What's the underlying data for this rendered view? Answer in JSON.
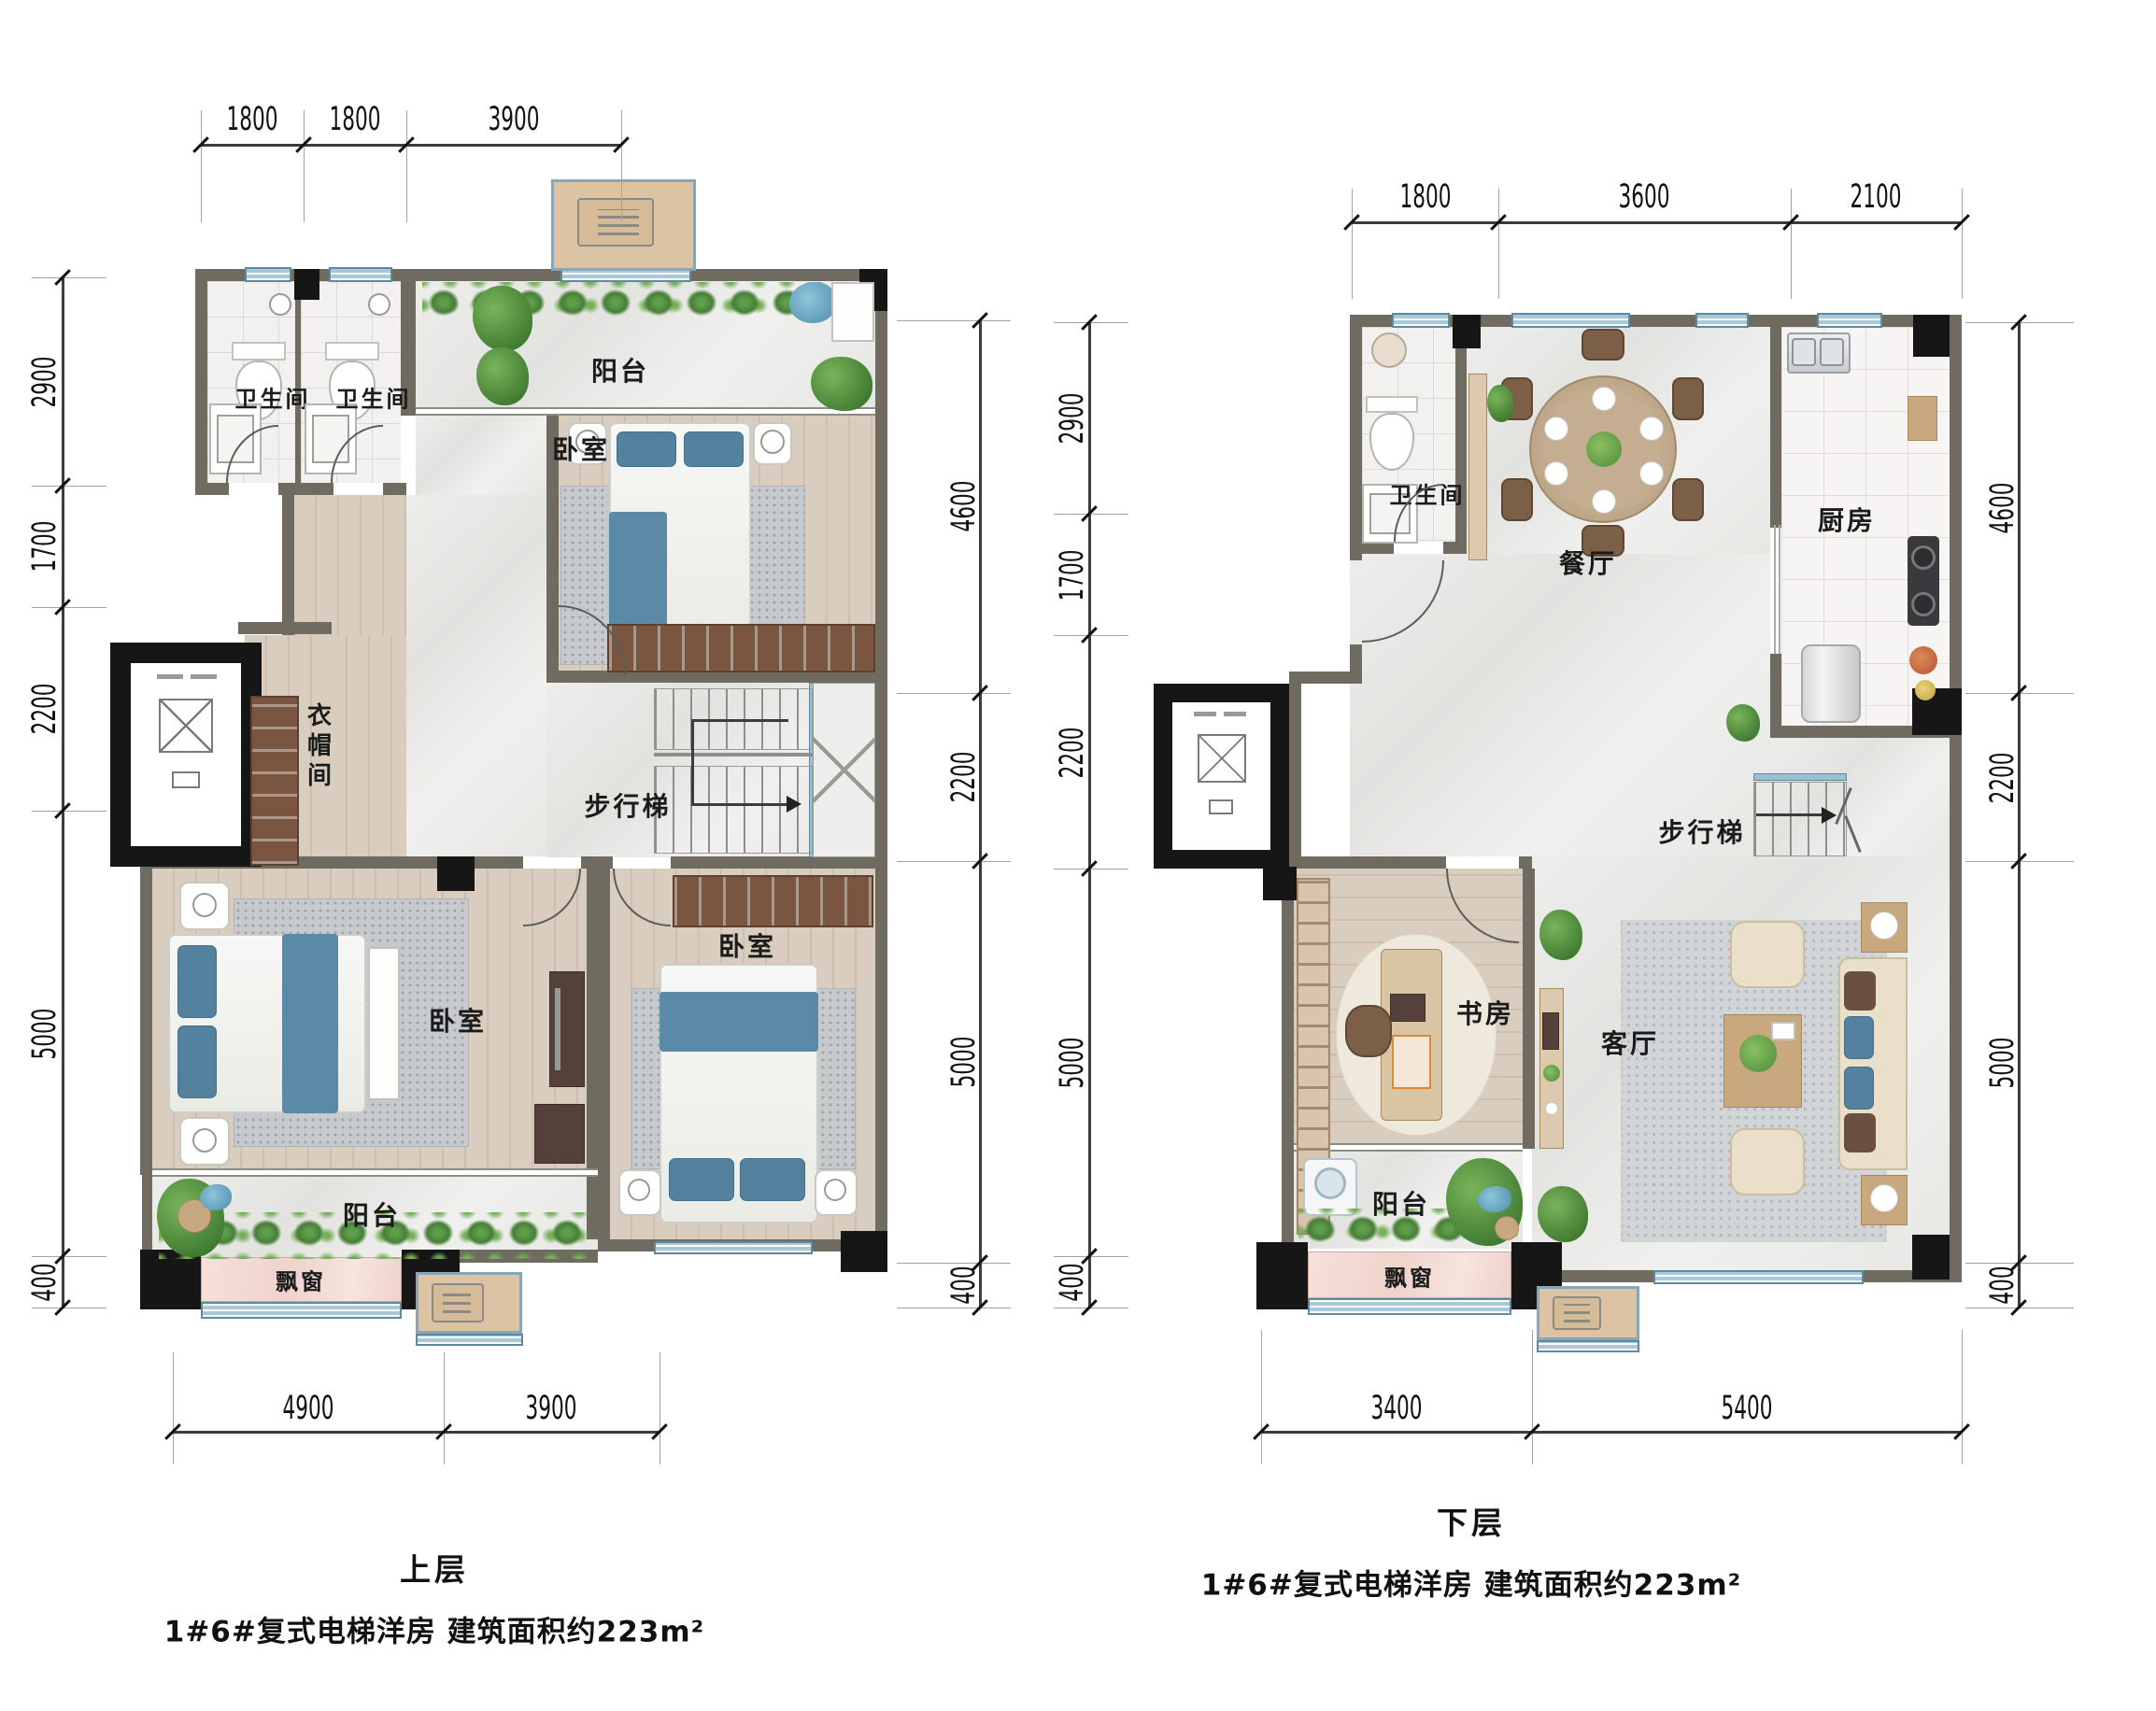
{
  "upper_label_note": "duplex floor plan, two plans side by side",
  "colors": {
    "wall": "#6f6b61",
    "column": "#161616",
    "window_blue": "#a9c9d9",
    "bay_pink": "#f6e0da",
    "wood_floor": "#d8cdbf",
    "marble_floor": "#ededeb",
    "plant_green": "#5e9e4b",
    "bed_blue": "#54819d",
    "ac_tan": "#dcc3a3"
  },
  "left_plan": {
    "title": "上层",
    "subtitle": "1#6#复式电梯洋房 建筑面积约223m²",
    "rooms": {
      "bath1": "卫生间",
      "bath2": "卫生间",
      "balcony_top": "阳台",
      "bedroom_top": "卧室",
      "closet": "衣帽间",
      "stairs": "步行梯",
      "bedroom_master": "卧室",
      "bedroom_right": "卧室",
      "balcony_bottom": "阳台",
      "bay_window": "飘窗"
    },
    "dims": {
      "top": [
        "1800",
        "1800",
        "3900"
      ],
      "left": [
        "2900",
        "1700",
        "2200",
        "5000",
        "400"
      ],
      "right": [
        "4600",
        "2200",
        "5000",
        "400"
      ],
      "bottom": [
        "4900",
        "3900"
      ]
    }
  },
  "right_plan": {
    "title": "下层",
    "subtitle": "1#6#复式电梯洋房 建筑面积约223m²",
    "rooms": {
      "bath": "卫生间",
      "dining": "餐厅",
      "kitchen": "厨房",
      "stairs": "步行梯",
      "study": "书房",
      "living": "客厅",
      "balcony": "阳台",
      "bay_window": "飘窗"
    },
    "dims": {
      "top": [
        "1800",
        "3600",
        "2100"
      ],
      "left": [
        "2900",
        "1700",
        "2200",
        "5000",
        "400"
      ],
      "right": [
        "4600",
        "2200",
        "5000",
        "400"
      ],
      "bottom": [
        "3400",
        "5400"
      ]
    }
  }
}
